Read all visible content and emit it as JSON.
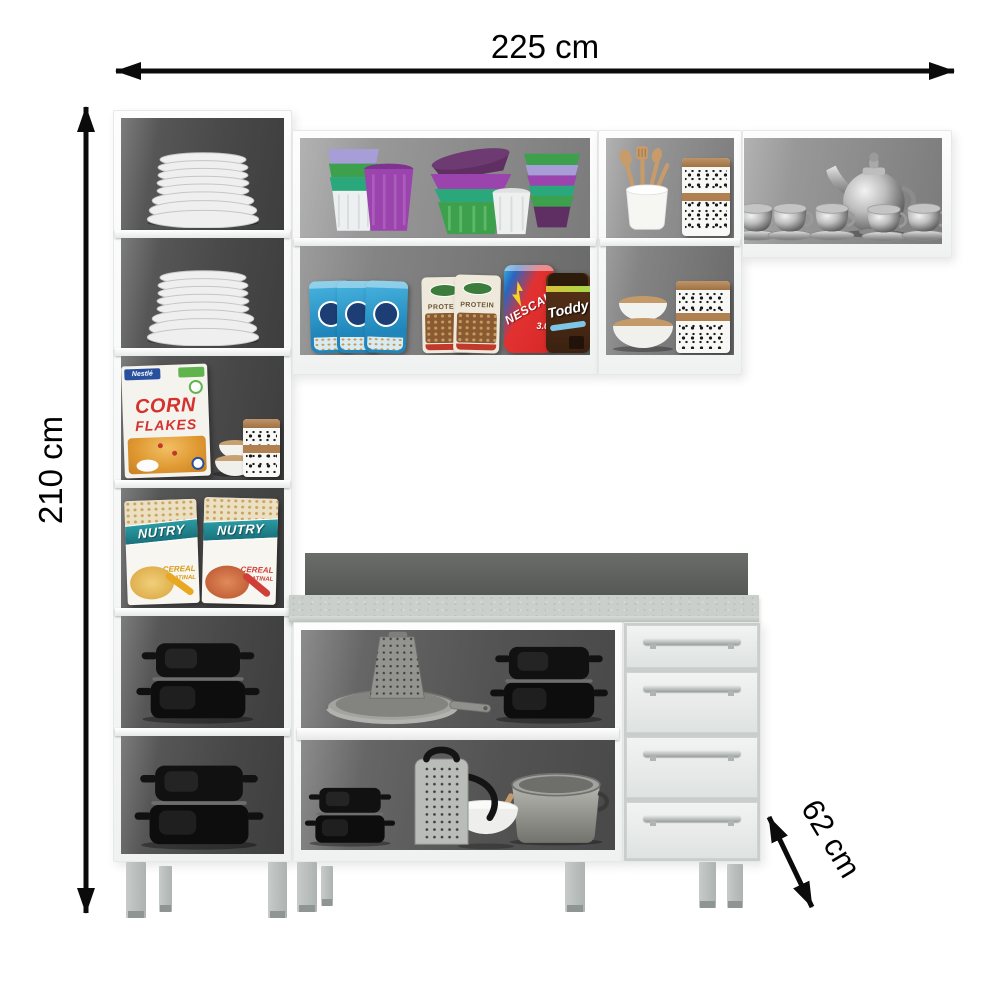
{
  "dimensions": {
    "width_label": "225 cm",
    "height_label": "210 cm",
    "depth_label": "62 cm"
  },
  "brands": {
    "nestle": "Nestlé",
    "corn_flakes_line1": "CORN",
    "corn_flakes_line2": "FLAKES",
    "nutry": "NUTRY",
    "nutry_sub1": "CEREAL",
    "nutry_sub2": "MATINAL",
    "protein": "PROTEIN",
    "nescau": "NESCAU",
    "nescau_version": "3.0",
    "toddy": "Toddy"
  },
  "furniture": {
    "description": "white modular kitchen cabinet set with open shelves, wall cabinets, countertop base cabinet and drawer unit",
    "left_column_shelves": [
      "stacked white plates",
      "stacked white plates",
      "corn flakes box with bowls and patterned canister",
      "two cereal boxes",
      "black roasting pan",
      "black roasting pan"
    ],
    "upper_middle_cabinet_shelves": [
      "colorful plastic cups and bowls",
      "snack pouches, cocoa pouch and chocolate jar"
    ],
    "upper_right_cabinet_shelves": [
      "wooden utensils in crock and patterned canister",
      "lidded bowls and patterned canister"
    ],
    "right_wall_shelf": [
      "silver teapot with tea cups"
    ],
    "base_cabinet_shelves": [
      "frying pan with box grater and black roasting pan",
      "black roasting pan, grater, bowl with spoon and steel pot"
    ],
    "drawer_count": 4
  },
  "colors": {
    "cabinet": "#fbfcfc",
    "interior_dark": "#4a4a4a",
    "interior_light": "#8f8f8f",
    "countertop": "#cbcfcb",
    "backsplash": "#5e605e",
    "drawer_front": "#e8ebea",
    "legs": "#b4b9b7",
    "dimension_lines": "#0b0b0b"
  }
}
